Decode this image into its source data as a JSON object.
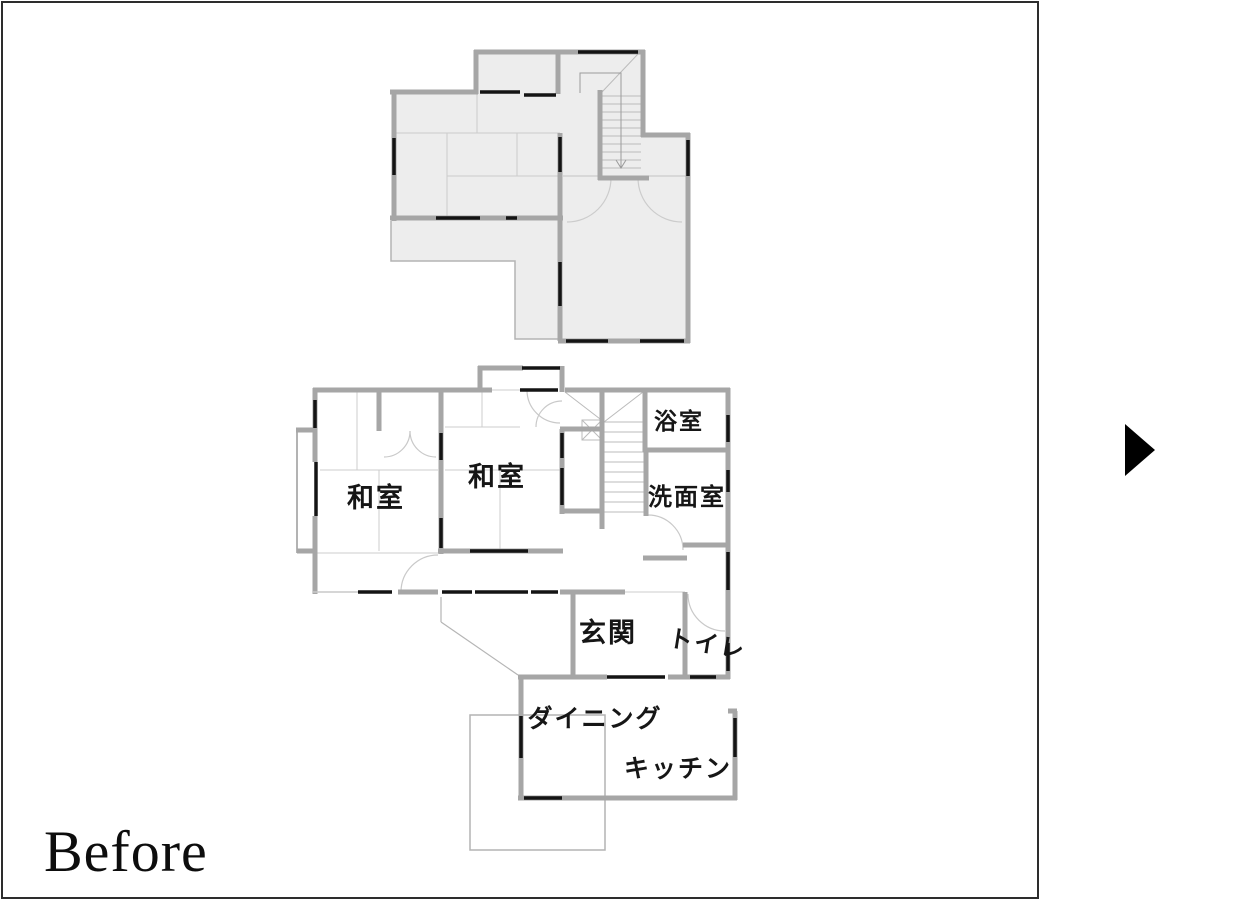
{
  "caption": {
    "label": "Before"
  },
  "navigation": {
    "arrow_direction": "right"
  },
  "colors": {
    "wall": "#a6a6a6",
    "opening": "#141414",
    "room_fill": "#ededed",
    "thin_line": "#c9c9c9",
    "panel_border": "#2d2d2d"
  },
  "floor1": {
    "rooms": {
      "washitsu_left": "和室",
      "washitsu_center": "和室",
      "bathroom": "浴室",
      "washroom": "洗面室",
      "entrance": "玄関",
      "toilet": "トイレ",
      "dining": "ダイニング",
      "kitchen": "キッチン"
    }
  }
}
